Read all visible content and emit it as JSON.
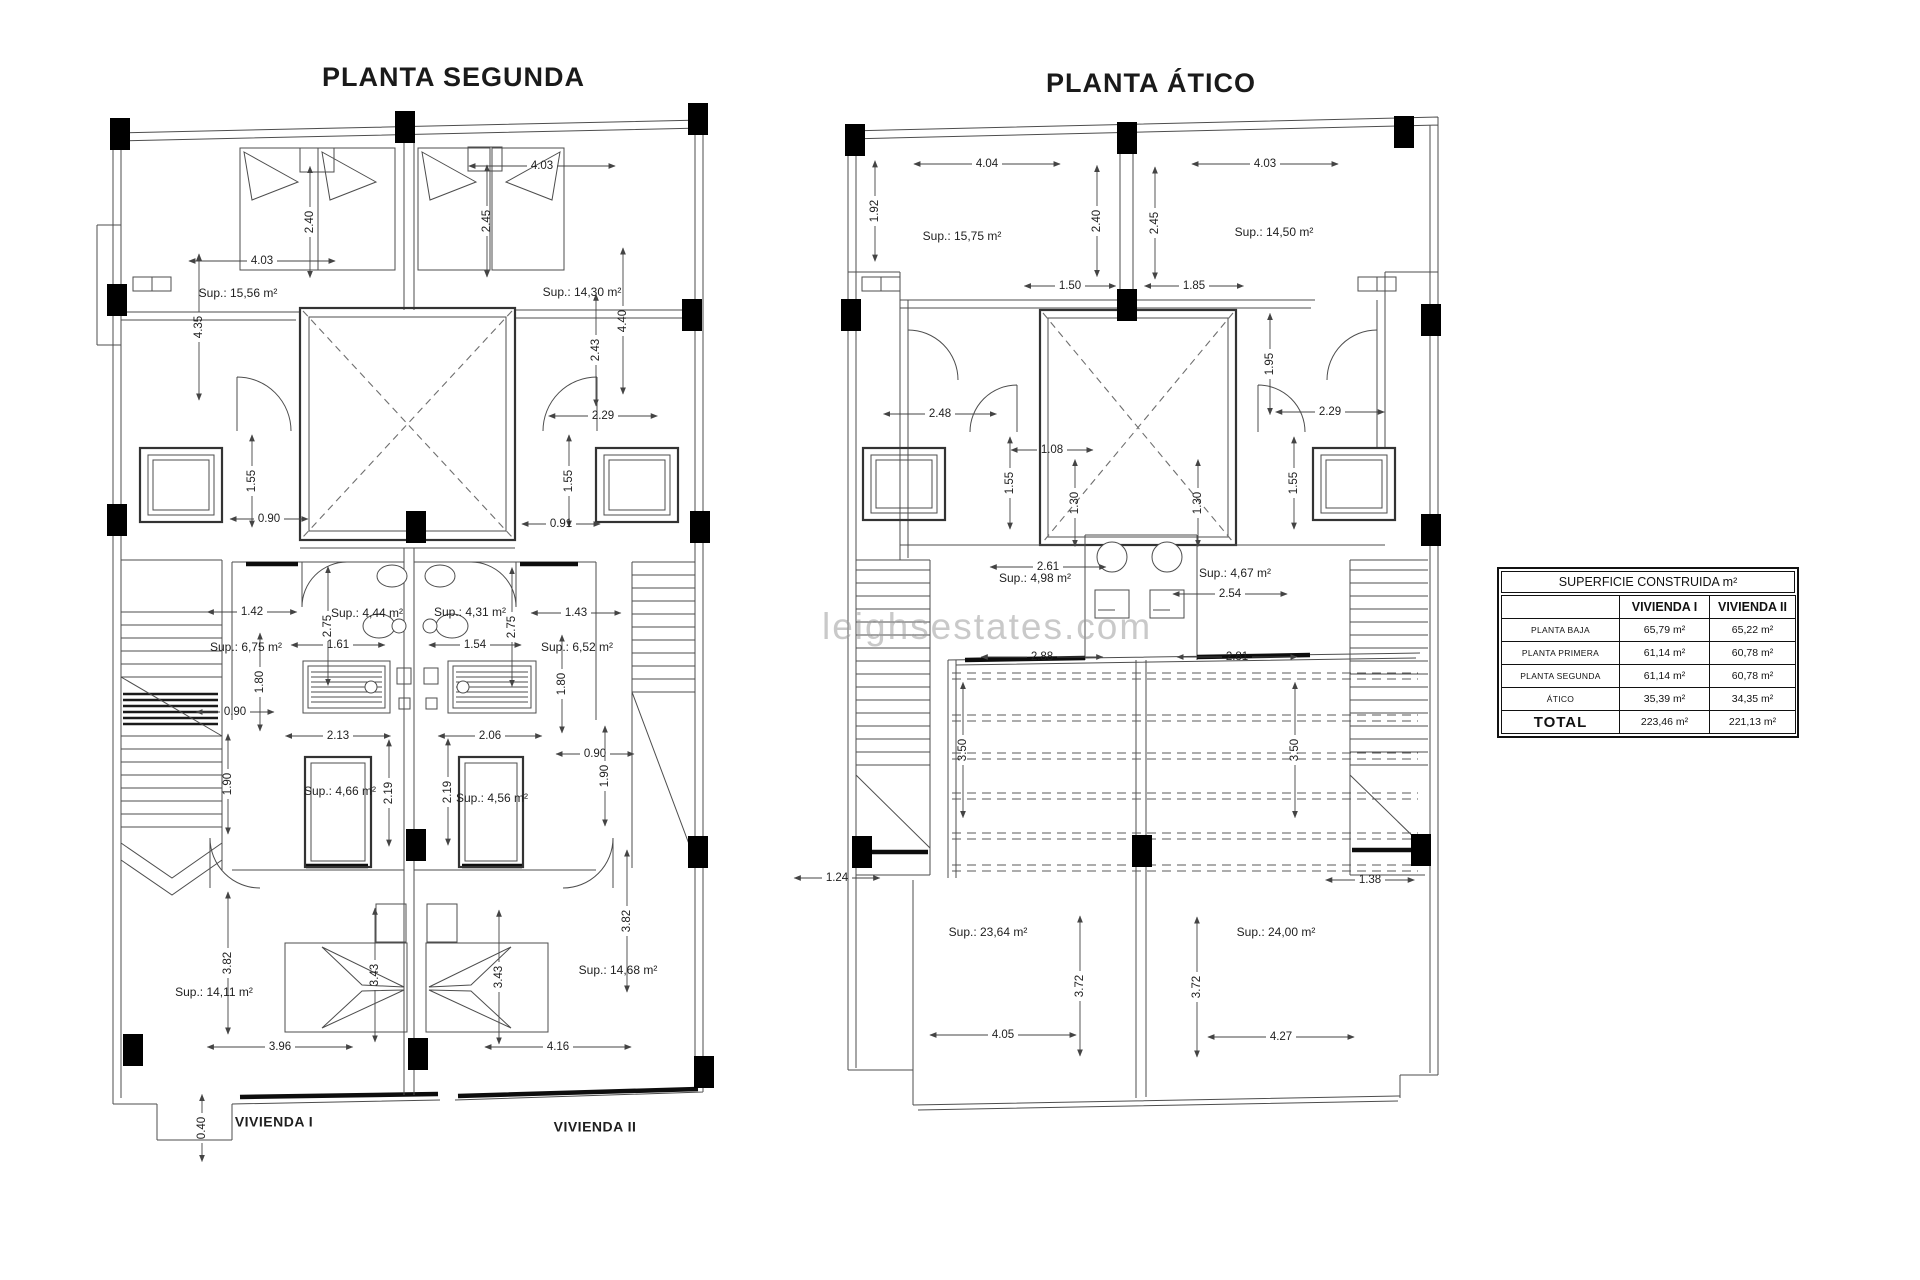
{
  "watermark": {
    "text": "leighsestates.com",
    "color": "#9e9e9e"
  },
  "plans": [
    {
      "title": "PLANTA SEGUNDA",
      "labels": [
        {
          "t": "4.03",
          "x": 542,
          "y": 166,
          "r": 0
        },
        {
          "t": "2.40",
          "x": 310,
          "y": 222,
          "r": -90
        },
        {
          "t": "2.45",
          "x": 487,
          "y": 221,
          "r": -90
        },
        {
          "t": "4.03",
          "x": 262,
          "y": 261,
          "r": 0
        },
        {
          "t": "4.35",
          "x": 199,
          "y": 327,
          "r": -90
        },
        {
          "t": "4.40",
          "x": 623,
          "y": 321,
          "r": -90
        },
        {
          "t": "2.43",
          "x": 596,
          "y": 350,
          "r": -90
        },
        {
          "t": "2.29",
          "x": 603,
          "y": 416,
          "r": 0
        },
        {
          "t": "1.55",
          "x": 252,
          "y": 481,
          "r": -90
        },
        {
          "t": "0.90",
          "x": 269,
          "y": 519,
          "r": 0
        },
        {
          "t": "1.55",
          "x": 569,
          "y": 481,
          "r": -90
        },
        {
          "t": "0.91",
          "x": 561,
          "y": 524,
          "r": 0
        },
        {
          "t": "1.42",
          "x": 252,
          "y": 612,
          "r": 0
        },
        {
          "t": "2.75",
          "x": 328,
          "y": 626,
          "r": -90
        },
        {
          "t": "1.61",
          "x": 338,
          "y": 645,
          "r": 0
        },
        {
          "t": "1.54",
          "x": 475,
          "y": 645,
          "r": 0
        },
        {
          "t": "2.75",
          "x": 512,
          "y": 627,
          "r": -90
        },
        {
          "t": "1.43",
          "x": 576,
          "y": 613,
          "r": 0
        },
        {
          "t": "1.80",
          "x": 260,
          "y": 682,
          "r": -90
        },
        {
          "t": "1.80",
          "x": 562,
          "y": 684,
          "r": -90
        },
        {
          "t": "0.90",
          "x": 235,
          "y": 712,
          "r": 0
        },
        {
          "t": "2.13",
          "x": 338,
          "y": 736,
          "r": 0
        },
        {
          "t": "2.06",
          "x": 490,
          "y": 736,
          "r": 0
        },
        {
          "t": "0.90",
          "x": 595,
          "y": 754,
          "r": 0
        },
        {
          "t": "1.90",
          "x": 228,
          "y": 784,
          "r": -90
        },
        {
          "t": "1.90",
          "x": 605,
          "y": 776,
          "r": -90
        },
        {
          "t": "2.19",
          "x": 389,
          "y": 793,
          "r": -90
        },
        {
          "t": "2.19",
          "x": 448,
          "y": 792,
          "r": -90
        },
        {
          "t": "3.82",
          "x": 228,
          "y": 963,
          "r": -90
        },
        {
          "t": "3.43",
          "x": 375,
          "y": 975,
          "r": -90
        },
        {
          "t": "3.43",
          "x": 499,
          "y": 977,
          "r": -90
        },
        {
          "t": "3.82",
          "x": 627,
          "y": 921,
          "r": -90
        },
        {
          "t": "3.96",
          "x": 280,
          "y": 1047,
          "r": 0
        },
        {
          "t": "4.16",
          "x": 558,
          "y": 1047,
          "r": 0
        },
        {
          "t": "0.40",
          "x": 202,
          "y": 1128,
          "r": -90
        },
        {
          "t": "Sup.: 15,56 m²",
          "x": 238,
          "y": 294,
          "type": "area"
        },
        {
          "t": "Sup.: 14,30 m²",
          "x": 582,
          "y": 293,
          "type": "area"
        },
        {
          "t": "Sup.: 4,44 m²",
          "x": 367,
          "y": 614,
          "type": "area"
        },
        {
          "t": "Sup.: 4,31 m²",
          "x": 470,
          "y": 613,
          "type": "area"
        },
        {
          "t": "Sup.: 6,75 m²",
          "x": 246,
          "y": 648,
          "type": "area"
        },
        {
          "t": "Sup.: 6,52 m²",
          "x": 577,
          "y": 648,
          "type": "area"
        },
        {
          "t": "Sup.: 4,66 m²",
          "x": 340,
          "y": 792,
          "type": "area"
        },
        {
          "t": "Sup.: 4,56 m²",
          "x": 492,
          "y": 799,
          "type": "area"
        },
        {
          "t": "Sup.: 14,11 m²",
          "x": 214,
          "y": 993,
          "type": "area"
        },
        {
          "t": "Sup.: 14,68 m²",
          "x": 618,
          "y": 971,
          "type": "area"
        },
        {
          "t": "VIVIENDA I",
          "x": 274,
          "y": 1123,
          "type": "name"
        },
        {
          "t": "VIVIENDA II",
          "x": 595,
          "y": 1128,
          "type": "name"
        }
      ]
    },
    {
      "title": "PLANTA ÁTICO",
      "labels": [
        {
          "t": "4.04",
          "x": 987,
          "y": 164,
          "r": 0
        },
        {
          "t": "4.03",
          "x": 1265,
          "y": 164,
          "r": 0
        },
        {
          "t": "1.92",
          "x": 875,
          "y": 211,
          "r": -90
        },
        {
          "t": "2.40",
          "x": 1097,
          "y": 221,
          "r": -90
        },
        {
          "t": "2.45",
          "x": 1155,
          "y": 223,
          "r": -90
        },
        {
          "t": "1.50",
          "x": 1070,
          "y": 286,
          "r": 0
        },
        {
          "t": "1.85",
          "x": 1194,
          "y": 286,
          "r": 0
        },
        {
          "t": "2.48",
          "x": 940,
          "y": 414,
          "r": 0
        },
        {
          "t": "1.08",
          "x": 1052,
          "y": 450,
          "r": 0
        },
        {
          "t": "1.95",
          "x": 1270,
          "y": 364,
          "r": -90
        },
        {
          "t": "2.29",
          "x": 1330,
          "y": 412,
          "r": 0
        },
        {
          "t": "1.55",
          "x": 1010,
          "y": 483,
          "r": -90
        },
        {
          "t": "1.30",
          "x": 1075,
          "y": 503,
          "r": -90
        },
        {
          "t": "1.30",
          "x": 1198,
          "y": 503,
          "r": -90
        },
        {
          "t": "1.55",
          "x": 1294,
          "y": 483,
          "r": -90
        },
        {
          "t": "2.61",
          "x": 1048,
          "y": 567,
          "r": 0
        },
        {
          "t": "2.54",
          "x": 1230,
          "y": 594,
          "r": 0
        },
        {
          "t": "2.88",
          "x": 1042,
          "y": 657,
          "r": 0
        },
        {
          "t": "2.81",
          "x": 1237,
          "y": 657,
          "r": 0
        },
        {
          "t": "3.50",
          "x": 963,
          "y": 750,
          "r": -90
        },
        {
          "t": "3.50",
          "x": 1295,
          "y": 750,
          "r": -90
        },
        {
          "t": "1.24",
          "x": 837,
          "y": 878,
          "r": 0
        },
        {
          "t": "1.38",
          "x": 1370,
          "y": 880,
          "r": 0
        },
        {
          "t": "3.72",
          "x": 1080,
          "y": 986,
          "r": -90
        },
        {
          "t": "3.72",
          "x": 1197,
          "y": 987,
          "r": -90
        },
        {
          "t": "4.05",
          "x": 1003,
          "y": 1035,
          "r": 0
        },
        {
          "t": "4.27",
          "x": 1281,
          "y": 1037,
          "r": 0
        },
        {
          "t": "Sup.: 15,75 m²",
          "x": 962,
          "y": 237,
          "type": "area"
        },
        {
          "t": "Sup.: 14,50 m²",
          "x": 1274,
          "y": 233,
          "type": "area"
        },
        {
          "t": "Sup.: 4,98 m²",
          "x": 1035,
          "y": 579,
          "type": "area"
        },
        {
          "t": "Sup.: 4,67 m²",
          "x": 1235,
          "y": 574,
          "type": "area"
        },
        {
          "t": "Sup.: 23,64 m²",
          "x": 988,
          "y": 933,
          "type": "area"
        },
        {
          "t": "Sup.: 24,00 m²",
          "x": 1276,
          "y": 933,
          "type": "area"
        }
      ]
    }
  ],
  "table": {
    "title": "SUPERFICIE CONSTRUIDA m²",
    "columns": [
      "",
      "VIVIENDA I",
      "VIVIENDA II"
    ],
    "rows": [
      {
        "label": "PLANTA BAJA",
        "v1": "65,79 m²",
        "v2": "65,22 m²"
      },
      {
        "label": "PLANTA PRIMERA",
        "v1": "61,14 m²",
        "v2": "60,78 m²"
      },
      {
        "label": "PLANTA SEGUNDA",
        "v1": "61,14 m²",
        "v2": "60,78 m²"
      },
      {
        "label": "ÁTICO",
        "v1": "35,39 m²",
        "v2": "34,35 m²"
      },
      {
        "label": "TOTAL",
        "v1": "223,46 m²",
        "v2": "221,13 m²"
      }
    ]
  }
}
